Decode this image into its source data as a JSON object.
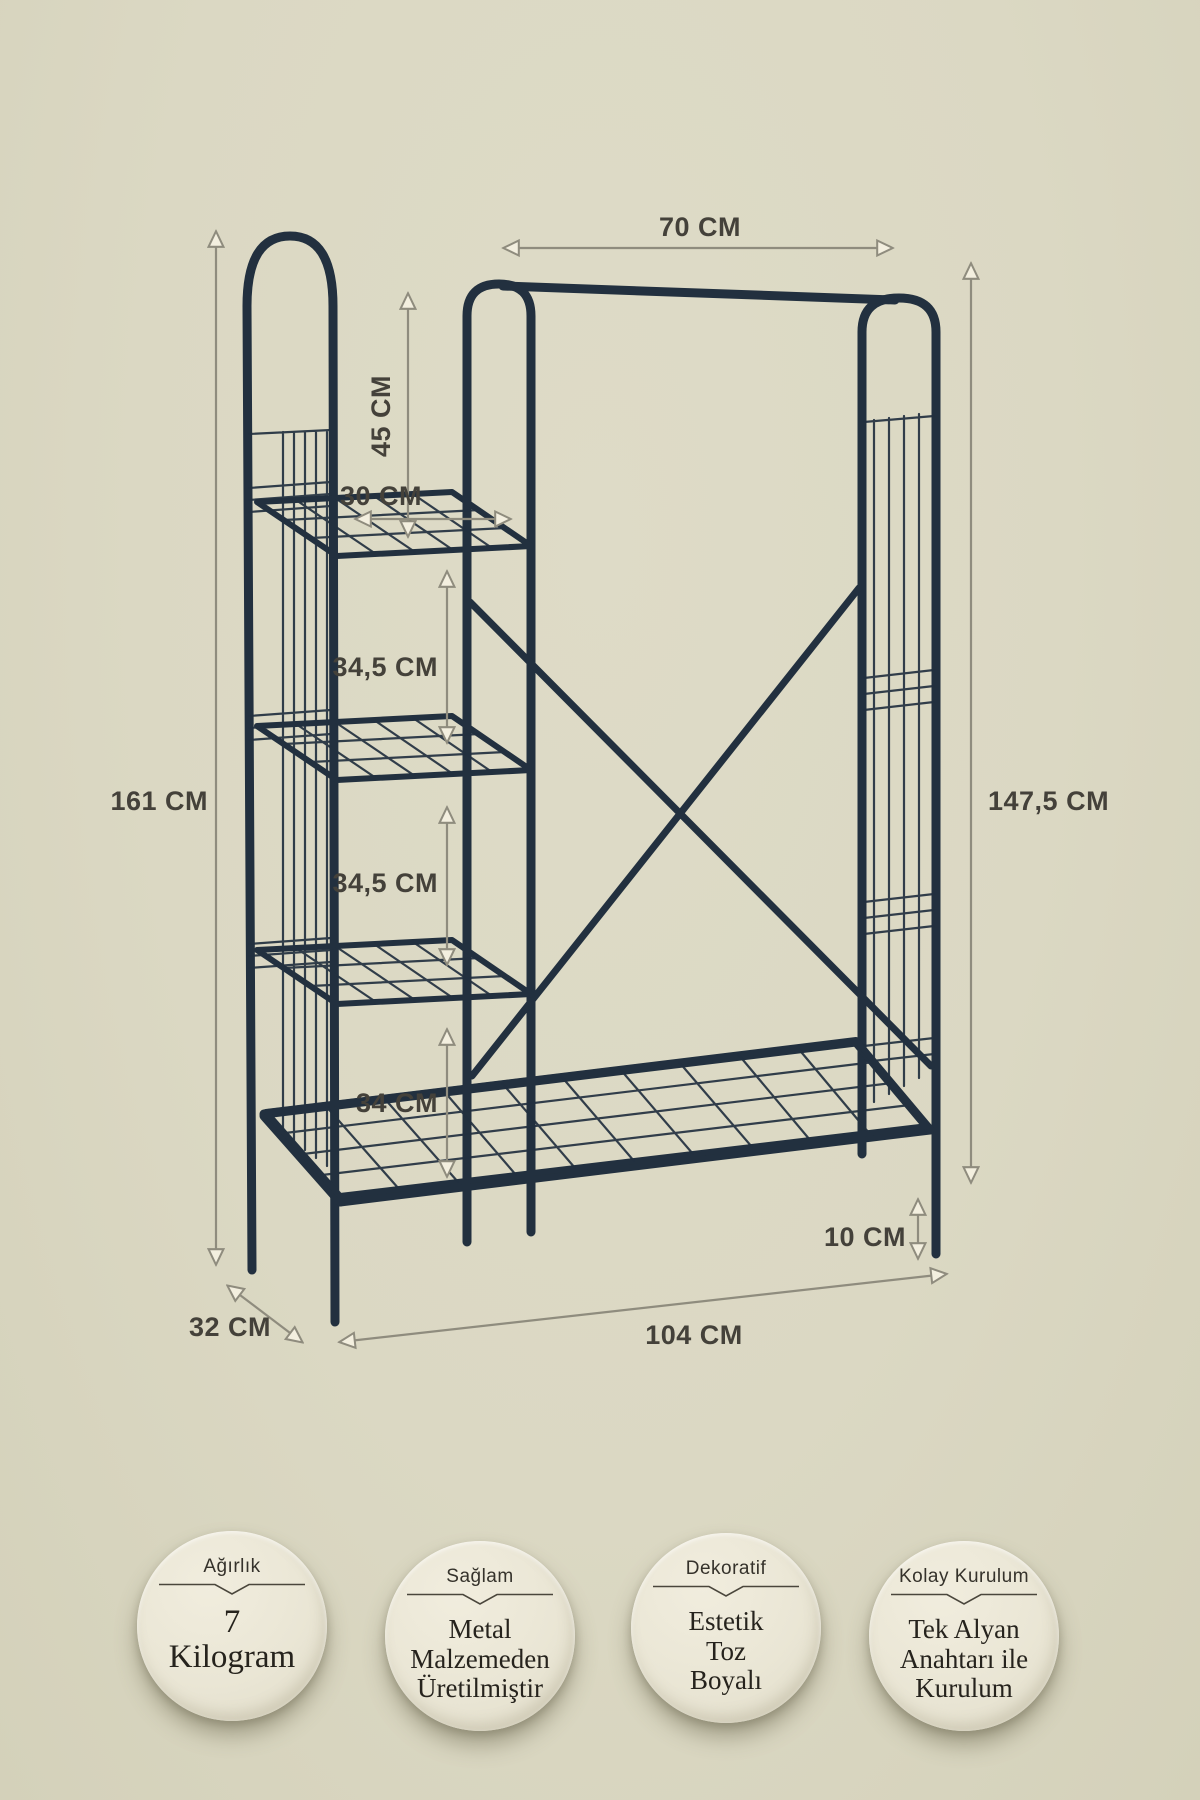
{
  "scene": {
    "background": "#dbd8c3",
    "frame_color": "#22303f",
    "dimension_line_color": "#8f8c7e",
    "label_color": "#44413a",
    "badge_fill": "#eae6d5"
  },
  "annotations": {
    "hanger_width": "70 CM",
    "top_gap_height": "45 CM",
    "shelf_width": "30 CM",
    "shelf_gap_1": "34,5 CM",
    "shelf_gap_2": "34,5 CM",
    "shelf_gap_3": "34 CM",
    "total_height": "161 CM",
    "side_height": "147,5 CM",
    "ground_clearance": "10 CM",
    "depth": "32 CM",
    "total_width": "104 CM"
  },
  "badges": [
    {
      "title": "Ağırlık",
      "lines": [
        "7",
        "Kilogram"
      ]
    },
    {
      "title": "Sağlam",
      "lines": [
        "Metal",
        "Malzemeden",
        "Üretilmiştir"
      ]
    },
    {
      "title": "Dekoratif",
      "lines": [
        "Estetik",
        "Toz",
        "Boyalı"
      ]
    },
    {
      "title": "Kolay Kurulum",
      "lines": [
        "Tek Alyan",
        "Anahtarı ile",
        "Kurulum"
      ]
    }
  ]
}
